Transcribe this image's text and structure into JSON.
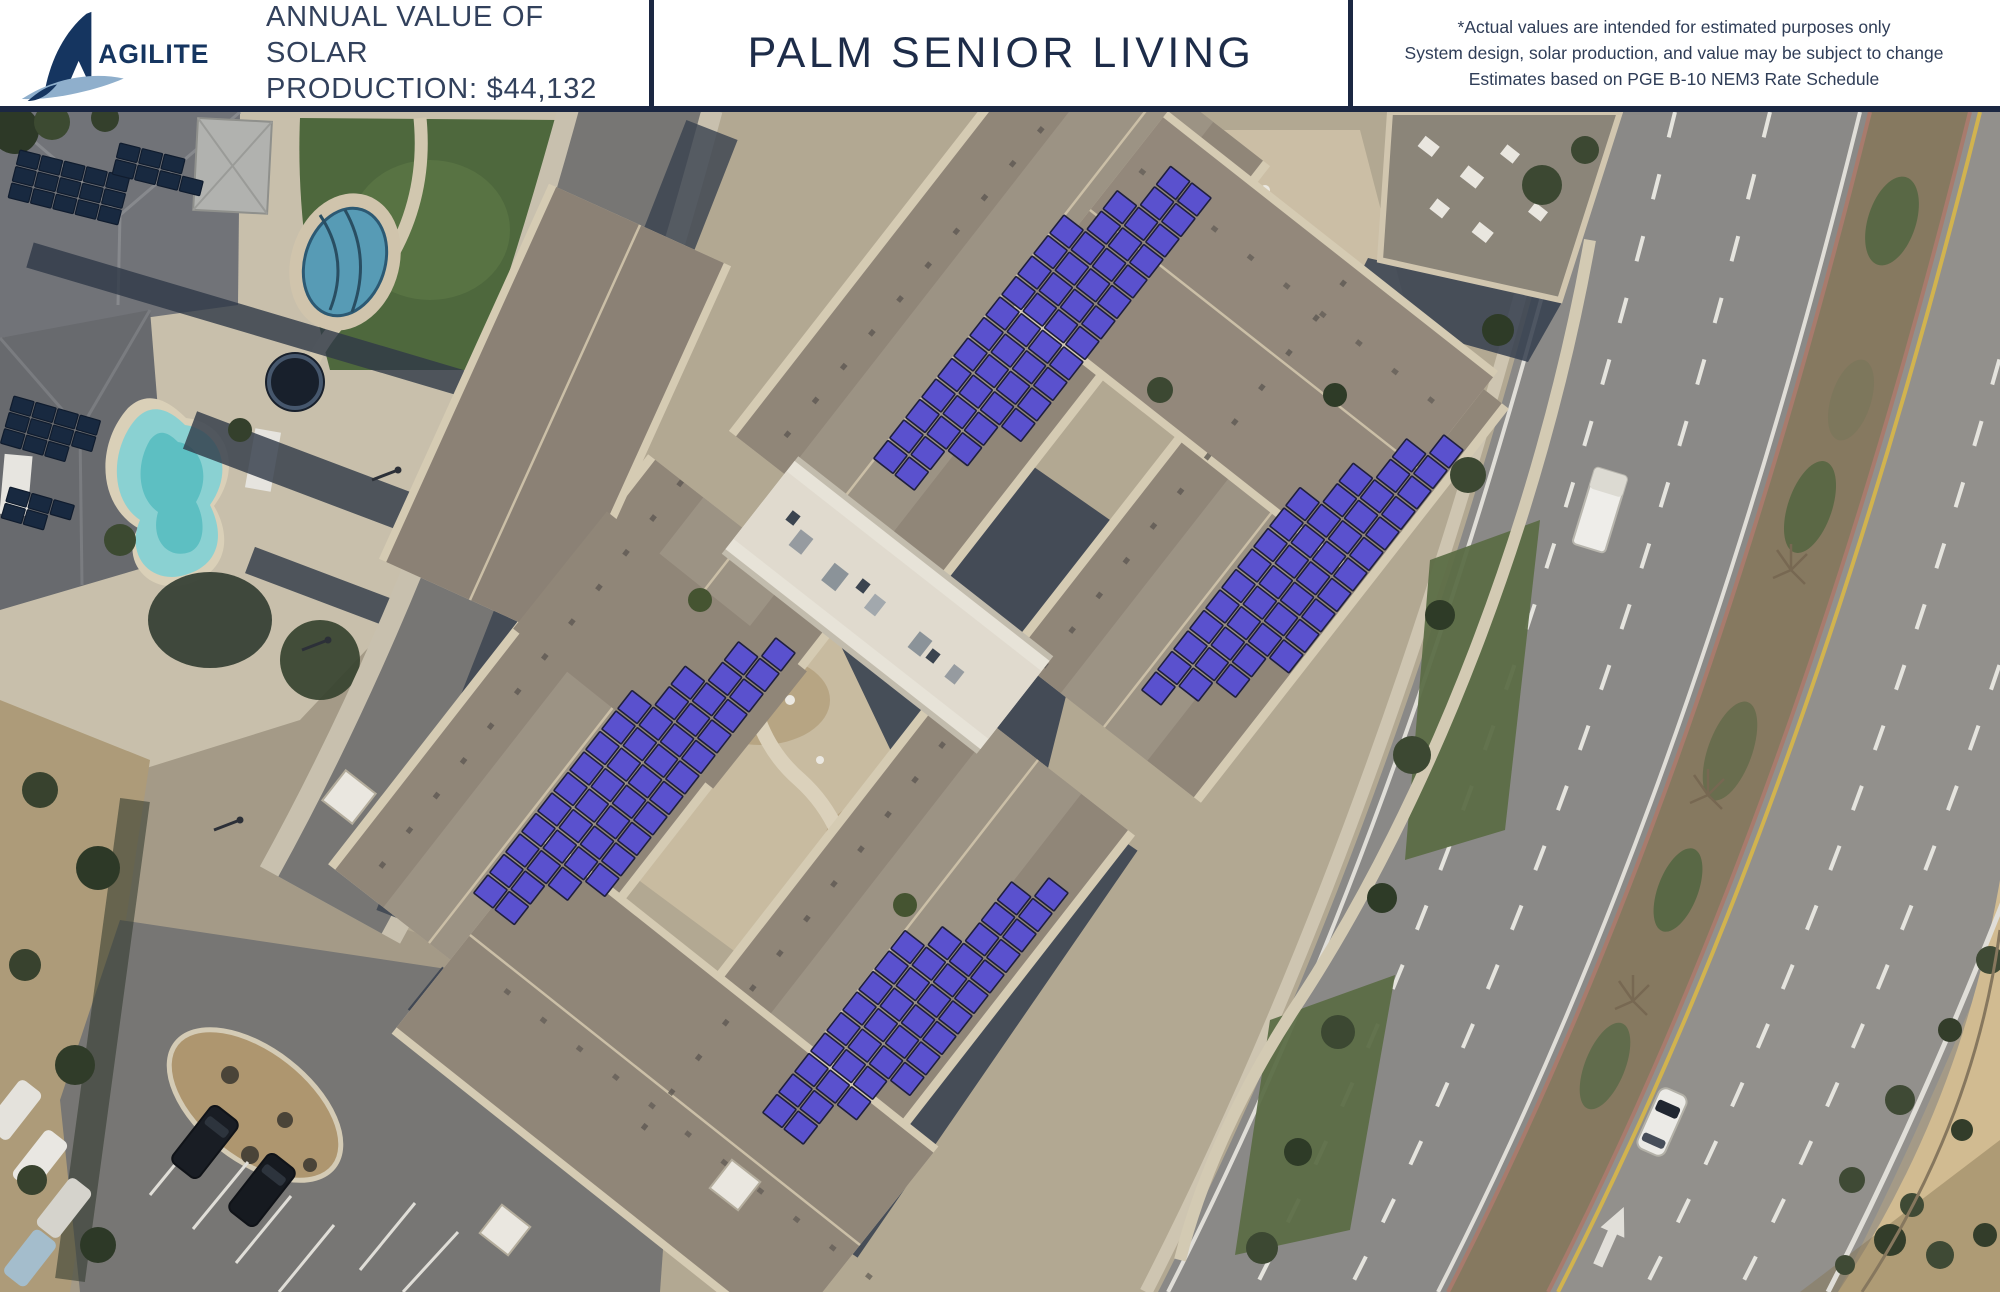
{
  "header": {
    "brand": "AGILITECH",
    "production": {
      "line1": "ANNUAL VALUE OF SOLAR",
      "line2": "PRODUCTION:  $44,132"
    },
    "title": "PALM SENIOR LIVING",
    "disclaimer": {
      "line1": "*Actual values are intended for estimated purposes only",
      "line2": "System design, solar production, and value may be subject to change",
      "line3": "Estimates based on PGE B-10 NEM3 Rate Schedule"
    }
  },
  "map": {
    "type": "aerial-satellite",
    "subject": "Palm Senior Living campus with proposed rooftop solar arrays",
    "solar_panel_color": "#5b52d4",
    "solar_panel_outline": "#1d1d3d",
    "residential_solar_color": "#16283f",
    "residential_solar_outline": "#0d1a2c",
    "arrays": [
      {
        "id": "roof-array-north",
        "panels": 52
      },
      {
        "id": "roof-array-east",
        "panels": 44
      },
      {
        "id": "roof-array-west",
        "panels": 46
      },
      {
        "id": "roof-array-south",
        "panels": 40
      }
    ]
  }
}
